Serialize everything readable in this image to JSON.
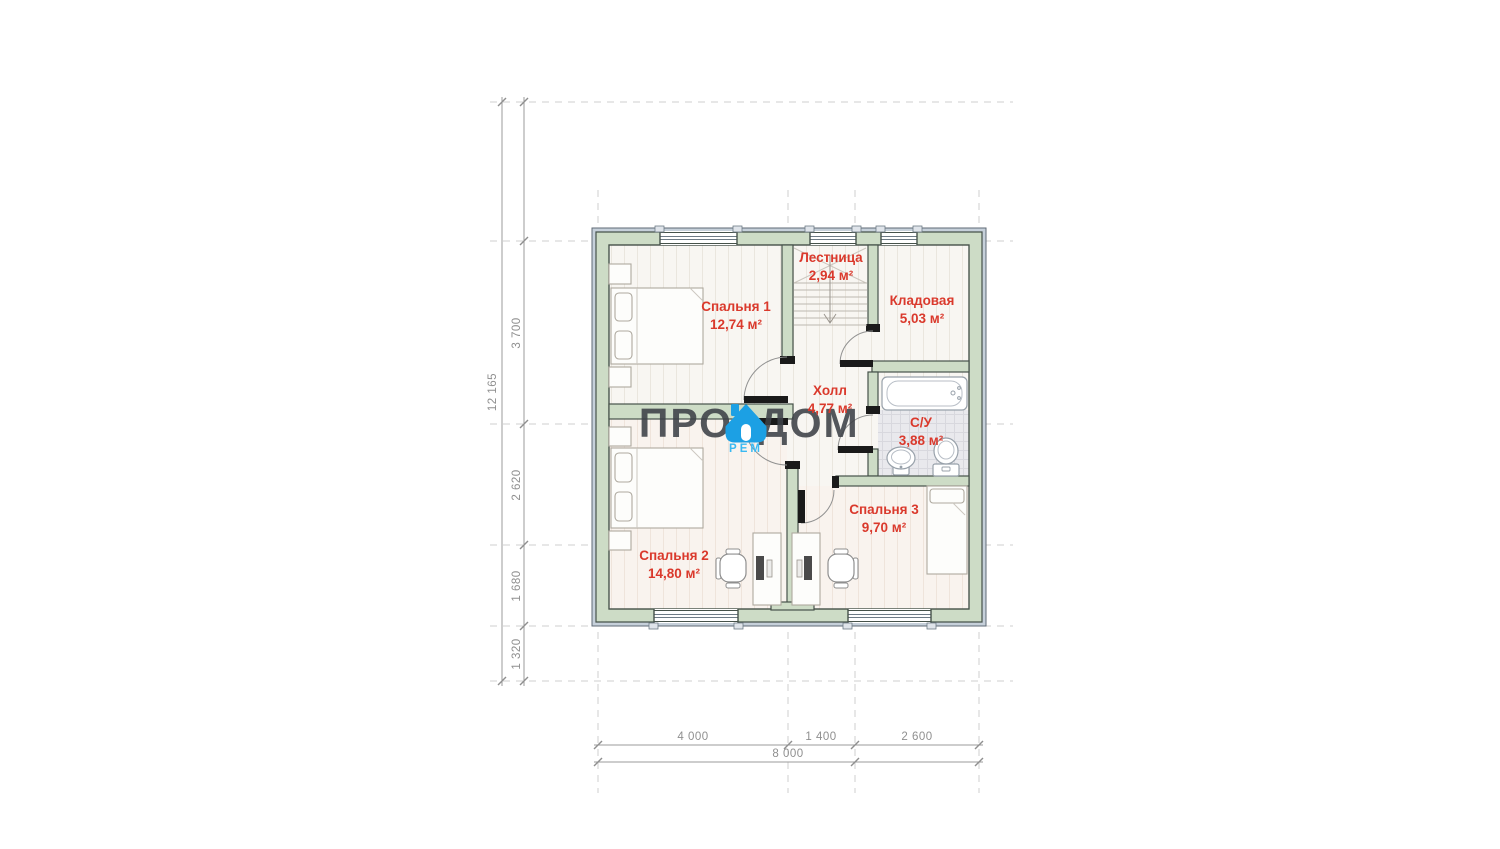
{
  "watermark": {
    "word_left": "ПРО",
    "word_right": "ДОМ",
    "word_sub": "РЕМ"
  },
  "rooms": [
    {
      "name": "Лестница",
      "area": "2,94 м²"
    },
    {
      "name": "Спальня 1",
      "area": "12,74 м²"
    },
    {
      "name": "Кладовая",
      "area": "5,03 м²"
    },
    {
      "name": "Холл",
      "area": "4,77 м²"
    },
    {
      "name": "С/У",
      "area": "3,88 м²"
    },
    {
      "name": "Спальня 3",
      "area": "9,70 м²"
    },
    {
      "name": "Спальня 2",
      "area": "14,80 м²"
    }
  ],
  "dimensions": {
    "vertical_total": "12 165",
    "vertical_segments": [
      "3 700",
      "2 620",
      "1 680",
      "1 320"
    ],
    "horizontal_segments": [
      "4 000",
      "1 400",
      "2 600"
    ],
    "horizontal_total": "8 000"
  },
  "colors": {
    "room_label": "#da392c",
    "wall_fill": "#cddcc6",
    "wall_edge": "#46524a",
    "facade_band": "#c6d0da",
    "watermark_text": "#3d4147",
    "watermark_blue": "#1ca0e4",
    "watermark_sub": "#39b9f2",
    "dimension_text": "#8f8f8f",
    "grid_dash": "#cdcdcd"
  }
}
